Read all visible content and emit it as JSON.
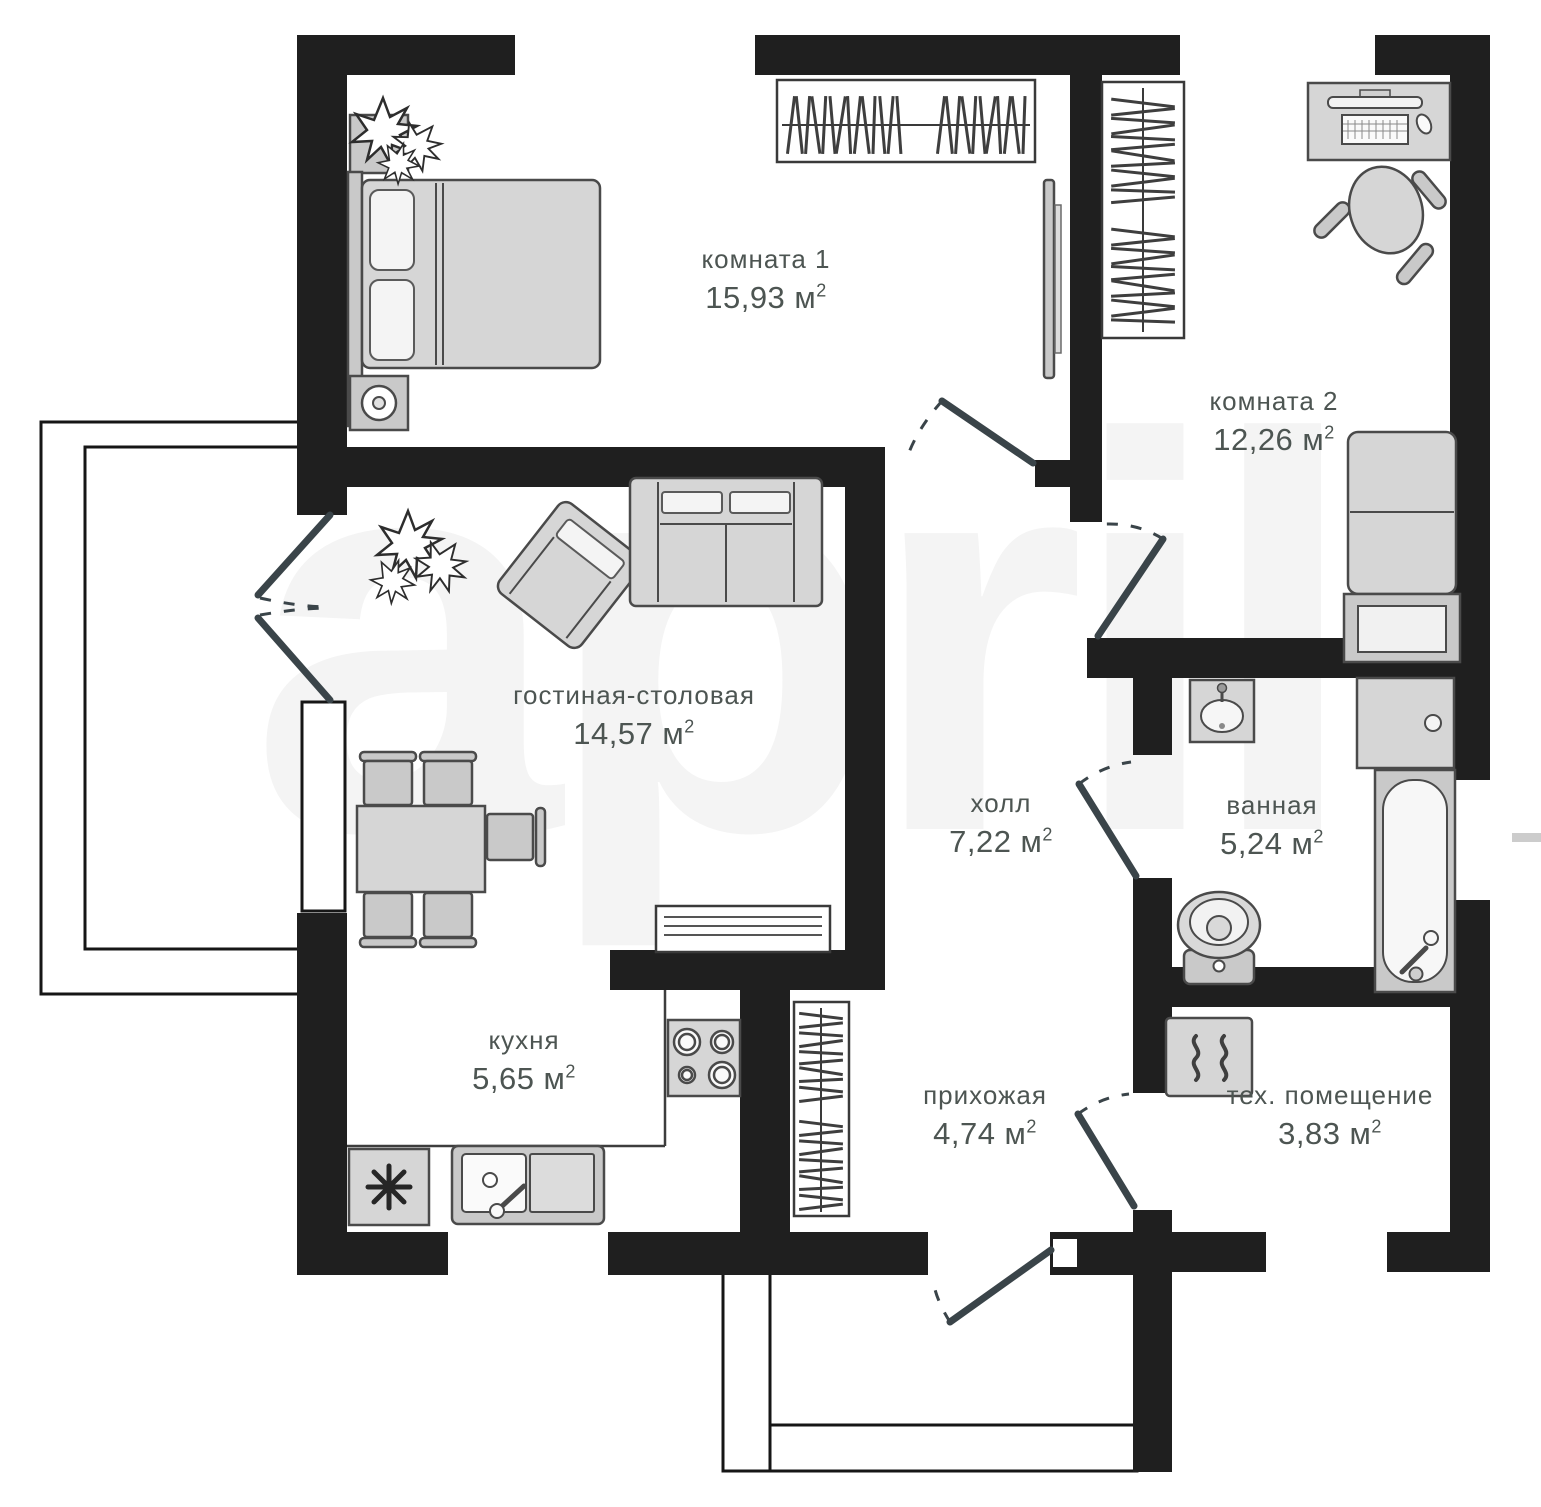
{
  "watermark": "april",
  "rooms": {
    "room1": {
      "name": "комната 1",
      "area": "15,93 м",
      "sup": "2"
    },
    "room2": {
      "name": "комната 2",
      "area": "12,26 м",
      "sup": "2"
    },
    "living": {
      "name": "гостиная-столовая",
      "area": "14,57 м",
      "sup": "2"
    },
    "hall": {
      "name": "холл",
      "area": "7,22 м",
      "sup": "2"
    },
    "bath": {
      "name": "ванная",
      "area": "5,24 м",
      "sup": "2"
    },
    "kitchen": {
      "name": "кухня",
      "area": "5,65 м",
      "sup": "2"
    },
    "entry": {
      "name": "прихожая",
      "area": "4,74 м",
      "sup": "2"
    },
    "tech": {
      "name": "тех. помещение",
      "area": "3,83 м",
      "sup": "2"
    }
  },
  "icons": {
    "fridge": "✳",
    "heater": "♨"
  },
  "colors": {
    "wall": "#1f1f1f",
    "door": "#3a4449",
    "label": "#4d5552",
    "watermark": "#f4f4f4"
  }
}
